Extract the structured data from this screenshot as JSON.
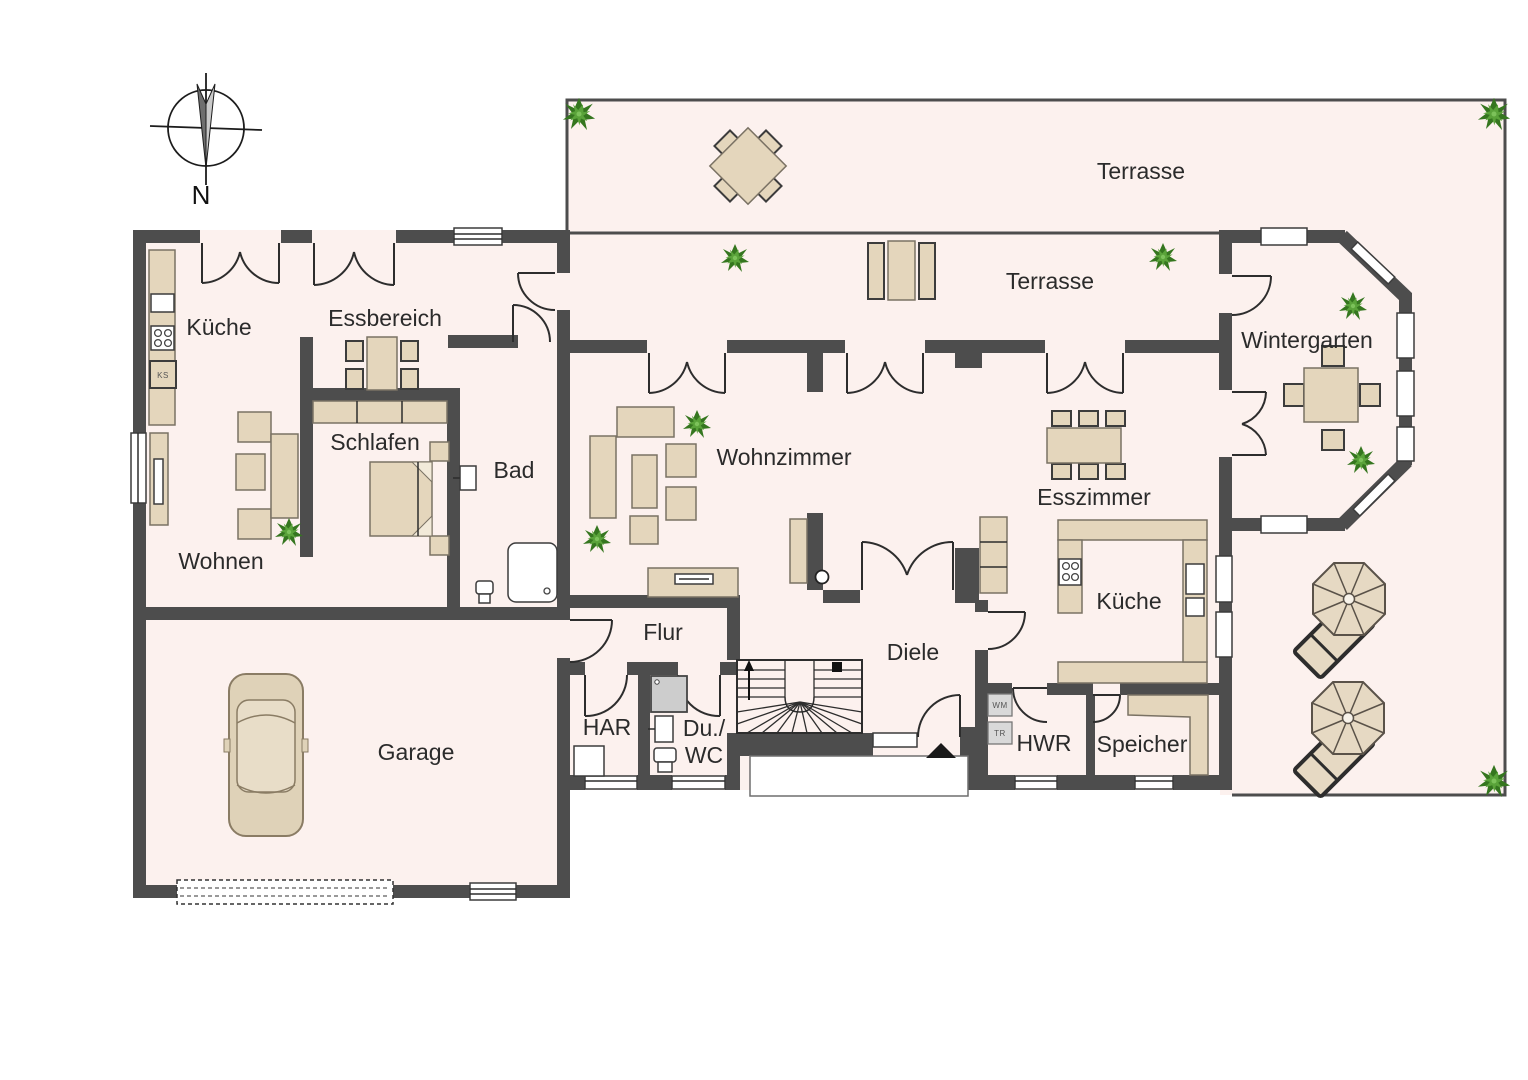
{
  "document": {
    "type": "floor-plan",
    "language": "de"
  },
  "compass": {
    "label": "N"
  },
  "colors": {
    "background": "#ffffff",
    "wall": "#4d4d4d",
    "floor": "#fcf1ee",
    "furniture": "#e4d6bc",
    "furniture_border": "#7a7264",
    "outline_ink": "#2d2d2d",
    "label_text": "#2b2b2b",
    "plant_green": "#4c8f3c",
    "appliance_gray": "#d9d9d9"
  },
  "rooms": {
    "granny_flat": {
      "kueche": "Küche",
      "essbereich": "Essbereich",
      "schlafen": "Schlafen",
      "bad": "Bad",
      "wohnen": "Wohnen",
      "garage": "Garage"
    },
    "main_house": {
      "flur": "Flur",
      "har": "HAR",
      "du_wc_line1": "Du./",
      "du_wc_line2": "WC",
      "diele": "Diele",
      "wohnzimmer": "Wohnzimmer",
      "esszimmer": "Esszimmer",
      "kueche": "Küche",
      "hwr": "HWR",
      "speicher": "Speicher",
      "wintergarten": "Wintergarten"
    },
    "outdoor": {
      "terrasse_upper": "Terrasse",
      "terrasse_mid": "Terrasse"
    }
  },
  "appliance_labels": {
    "ks": "KS",
    "wm": "WM",
    "tr": "TR"
  }
}
